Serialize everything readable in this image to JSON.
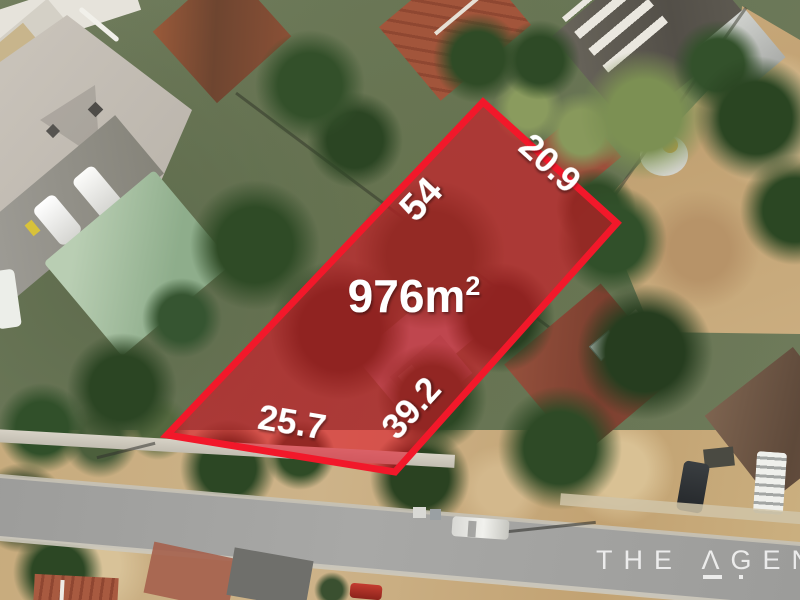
{
  "lot_overlay": {
    "area_value": "976m",
    "area_superscript": "2",
    "edge_lengths": {
      "upper_left": "54",
      "upper_right": "20.9",
      "lower_right": "39.2",
      "lower_left": "25.7"
    },
    "fill_color": "#dc1022",
    "border_color": "#f2182a",
    "label_color": "#ffffff"
  },
  "watermark": {
    "text": "THE ΛGENC",
    "color": "rgba(255,255,255,0.8)"
  }
}
